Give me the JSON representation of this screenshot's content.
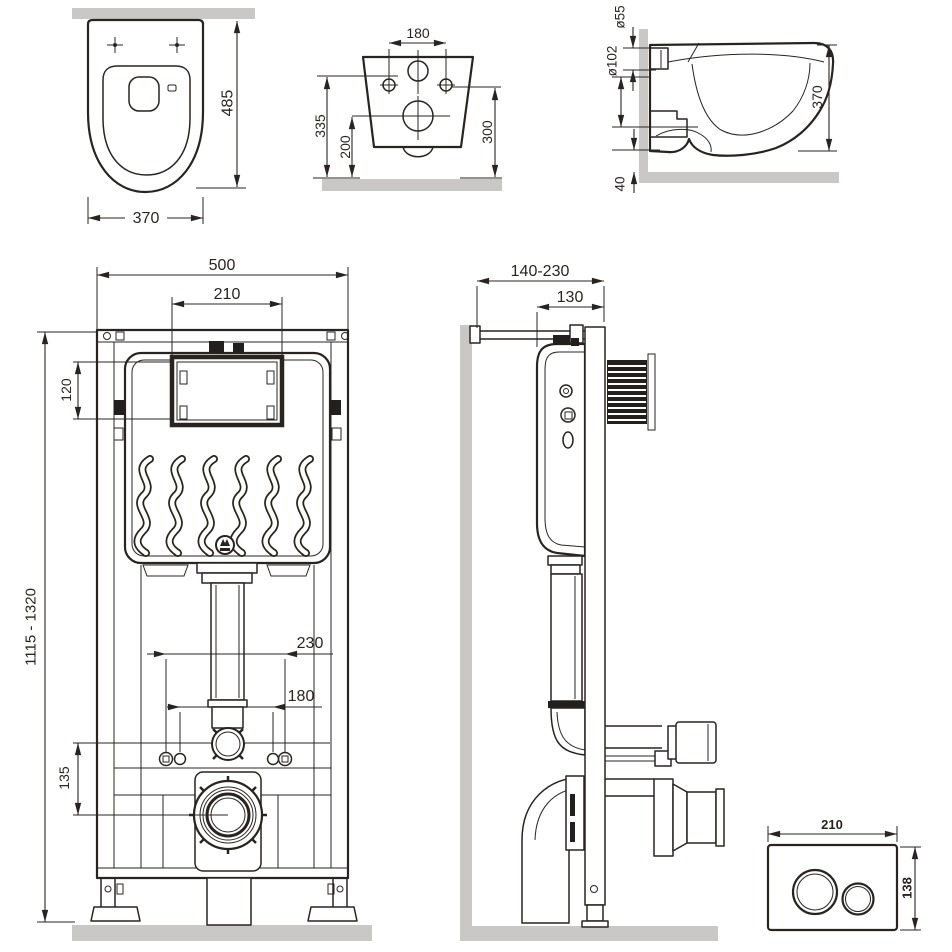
{
  "colors": {
    "background": "#ffffff",
    "line": "#2a2421",
    "wall_fill": "#c9c8c6"
  },
  "views": {
    "bowl_front": {
      "dims": {
        "height": "485",
        "width": "370"
      }
    },
    "bowl_rear": {
      "dims": {
        "hole_spacing": "180",
        "inlet_height": "335",
        "outlet_height": "200",
        "hole_height": "300"
      }
    },
    "bowl_side": {
      "dims": {
        "inlet_diameter": "ø55",
        "outlet_diameter": "ø102",
        "height": "370",
        "bottom_gap": "40"
      }
    },
    "frame_front": {
      "dims": {
        "frame_width": "500",
        "window_width": "210",
        "window_height": "120",
        "height_range": "1115 - 1320",
        "stud_outer": "230",
        "stud_inner": "180",
        "drain_offset": "135"
      }
    },
    "frame_side": {
      "dims": {
        "depth_range": "140-230",
        "frame_depth": "130"
      }
    },
    "flush_plate": {
      "dims": {
        "width": "210",
        "height": "138"
      }
    }
  }
}
